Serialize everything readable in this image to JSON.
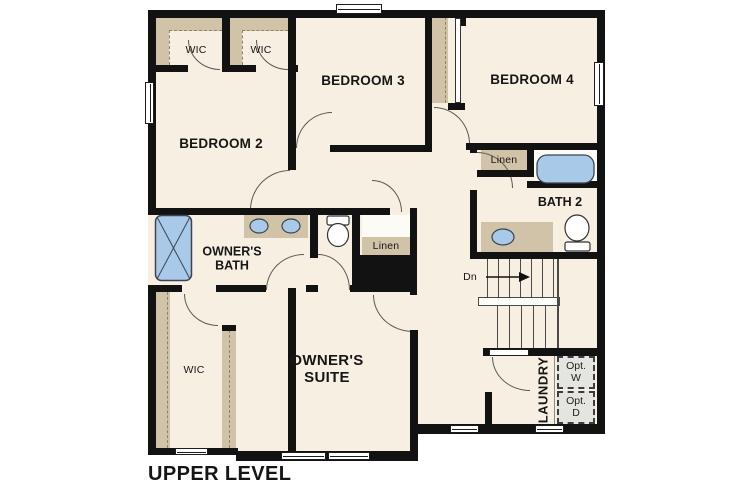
{
  "title": "UPPER LEVEL",
  "labels": {
    "wic_bedroom2": "WIC",
    "wic_bedroom3": "WIC",
    "wic_owners": "WIC",
    "bedroom2": "BEDROOM 2",
    "bedroom3": "BEDROOM 3",
    "bedroom4": "BEDROOM 4",
    "bath2": "BATH 2",
    "linen_bath2": "Linen",
    "linen_hall": "Linen",
    "owners_bath": [
      "OWNER'S",
      "BATH"
    ],
    "owners_suite": [
      "OWNER'S",
      "SUITE"
    ],
    "stairs_down": "Dn",
    "laundry": "LAUNDRY",
    "opt_washer": [
      "Opt.",
      "W"
    ],
    "opt_dryer": [
      "Opt.",
      "D"
    ]
  },
  "colors": {
    "wall": "#121212",
    "floor": "#f6efe2",
    "accent_tan": "#d1c3a8",
    "fixture_blue": "#a9c9e9",
    "optional_gray": "#e4e4e1",
    "page_bg": "#ffffff",
    "line": "#5a5a52"
  },
  "fixtures": [
    "shower",
    "double-sink-vanity",
    "toilet",
    "linen-shelf",
    "bathtub",
    "sink-vanity",
    "stairs-down",
    "optional-washer",
    "optional-dryer"
  ]
}
